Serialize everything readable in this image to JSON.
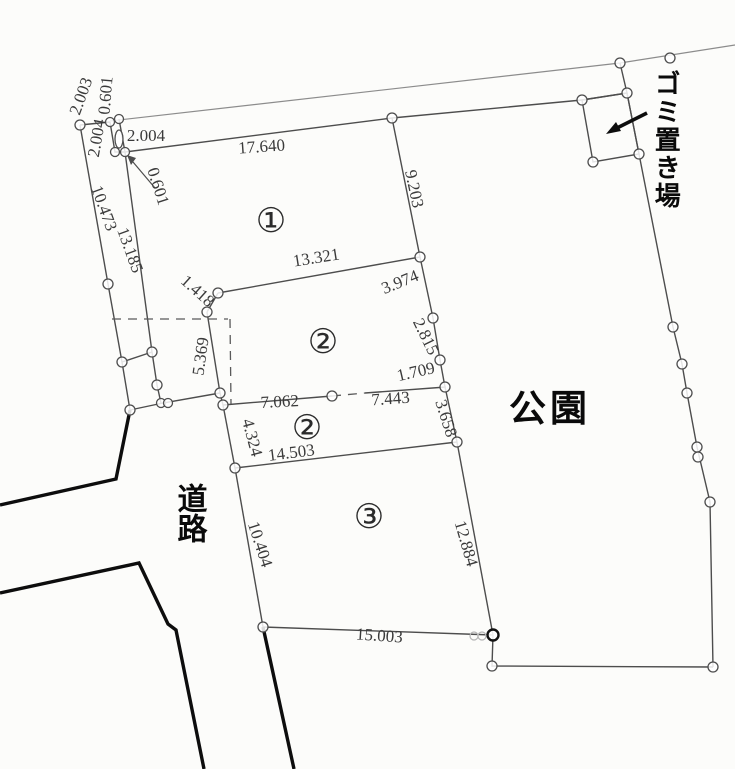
{
  "map": {
    "region_labels": {
      "park": "公園",
      "road": "道路",
      "garbage": "ゴミ置き場"
    },
    "parcels": [
      {
        "label": "①",
        "x": 271,
        "y": 232
      },
      {
        "label": "②",
        "x": 323,
        "y": 353
      },
      {
        "label": "②",
        "x": 307,
        "y": 439
      },
      {
        "label": "③",
        "x": 369,
        "y": 528
      }
    ],
    "dimensions": [
      {
        "text": "17.640",
        "x": 262,
        "y": 152,
        "rot": -4
      },
      {
        "text": "9.203",
        "x": 409,
        "y": 190,
        "rot": 78
      },
      {
        "text": "13.321",
        "x": 317,
        "y": 263,
        "rot": -9
      },
      {
        "text": "1.418",
        "x": 194,
        "y": 295,
        "rot": 42
      },
      {
        "text": "5.369",
        "x": 206,
        "y": 357,
        "rot": -82
      },
      {
        "text": "3.974",
        "x": 402,
        "y": 287,
        "rot": -22
      },
      {
        "text": "2.815",
        "x": 421,
        "y": 339,
        "rot": 64
      },
      {
        "text": "1.709",
        "x": 417,
        "y": 377,
        "rot": -13
      },
      {
        "text": "7.062",
        "x": 280,
        "y": 407,
        "rot": -3
      },
      {
        "text": "7.443",
        "x": 391,
        "y": 404,
        "rot": -4
      },
      {
        "text": "3.658",
        "x": 441,
        "y": 420,
        "rot": 72
      },
      {
        "text": "4.324",
        "x": 247,
        "y": 439,
        "rot": 75
      },
      {
        "text": "14.503",
        "x": 292,
        "y": 458,
        "rot": -7
      },
      {
        "text": "10.404",
        "x": 255,
        "y": 546,
        "rot": 72
      },
      {
        "text": "12.884",
        "x": 461,
        "y": 545,
        "rot": 74
      },
      {
        "text": "15.003",
        "x": 379,
        "y": 641,
        "rot": 4
      },
      {
        "text": "10.473",
        "x": 99,
        "y": 210,
        "rot": 70
      },
      {
        "text": "13.185",
        "x": 125,
        "y": 252,
        "rot": 70
      },
      {
        "text": "2.003",
        "x": 86,
        "y": 98,
        "rot": -70
      },
      {
        "text": "0.601",
        "x": 111,
        "y": 96,
        "rot": -85
      },
      {
        "text": "2.004",
        "x": 102,
        "y": 139,
        "rot": -80
      },
      {
        "text": "2.004",
        "x": 146,
        "y": 141,
        "rot": 0
      },
      {
        "text": "0.601",
        "x": 153,
        "y": 188,
        "rot": 72
      }
    ],
    "colors": {
      "line": "#4d4d4d",
      "road_line": "#0d0d0d",
      "dim_text": "#3a3a3a",
      "label_text": "#0a0a0a",
      "background": "#fcfcfa"
    }
  }
}
